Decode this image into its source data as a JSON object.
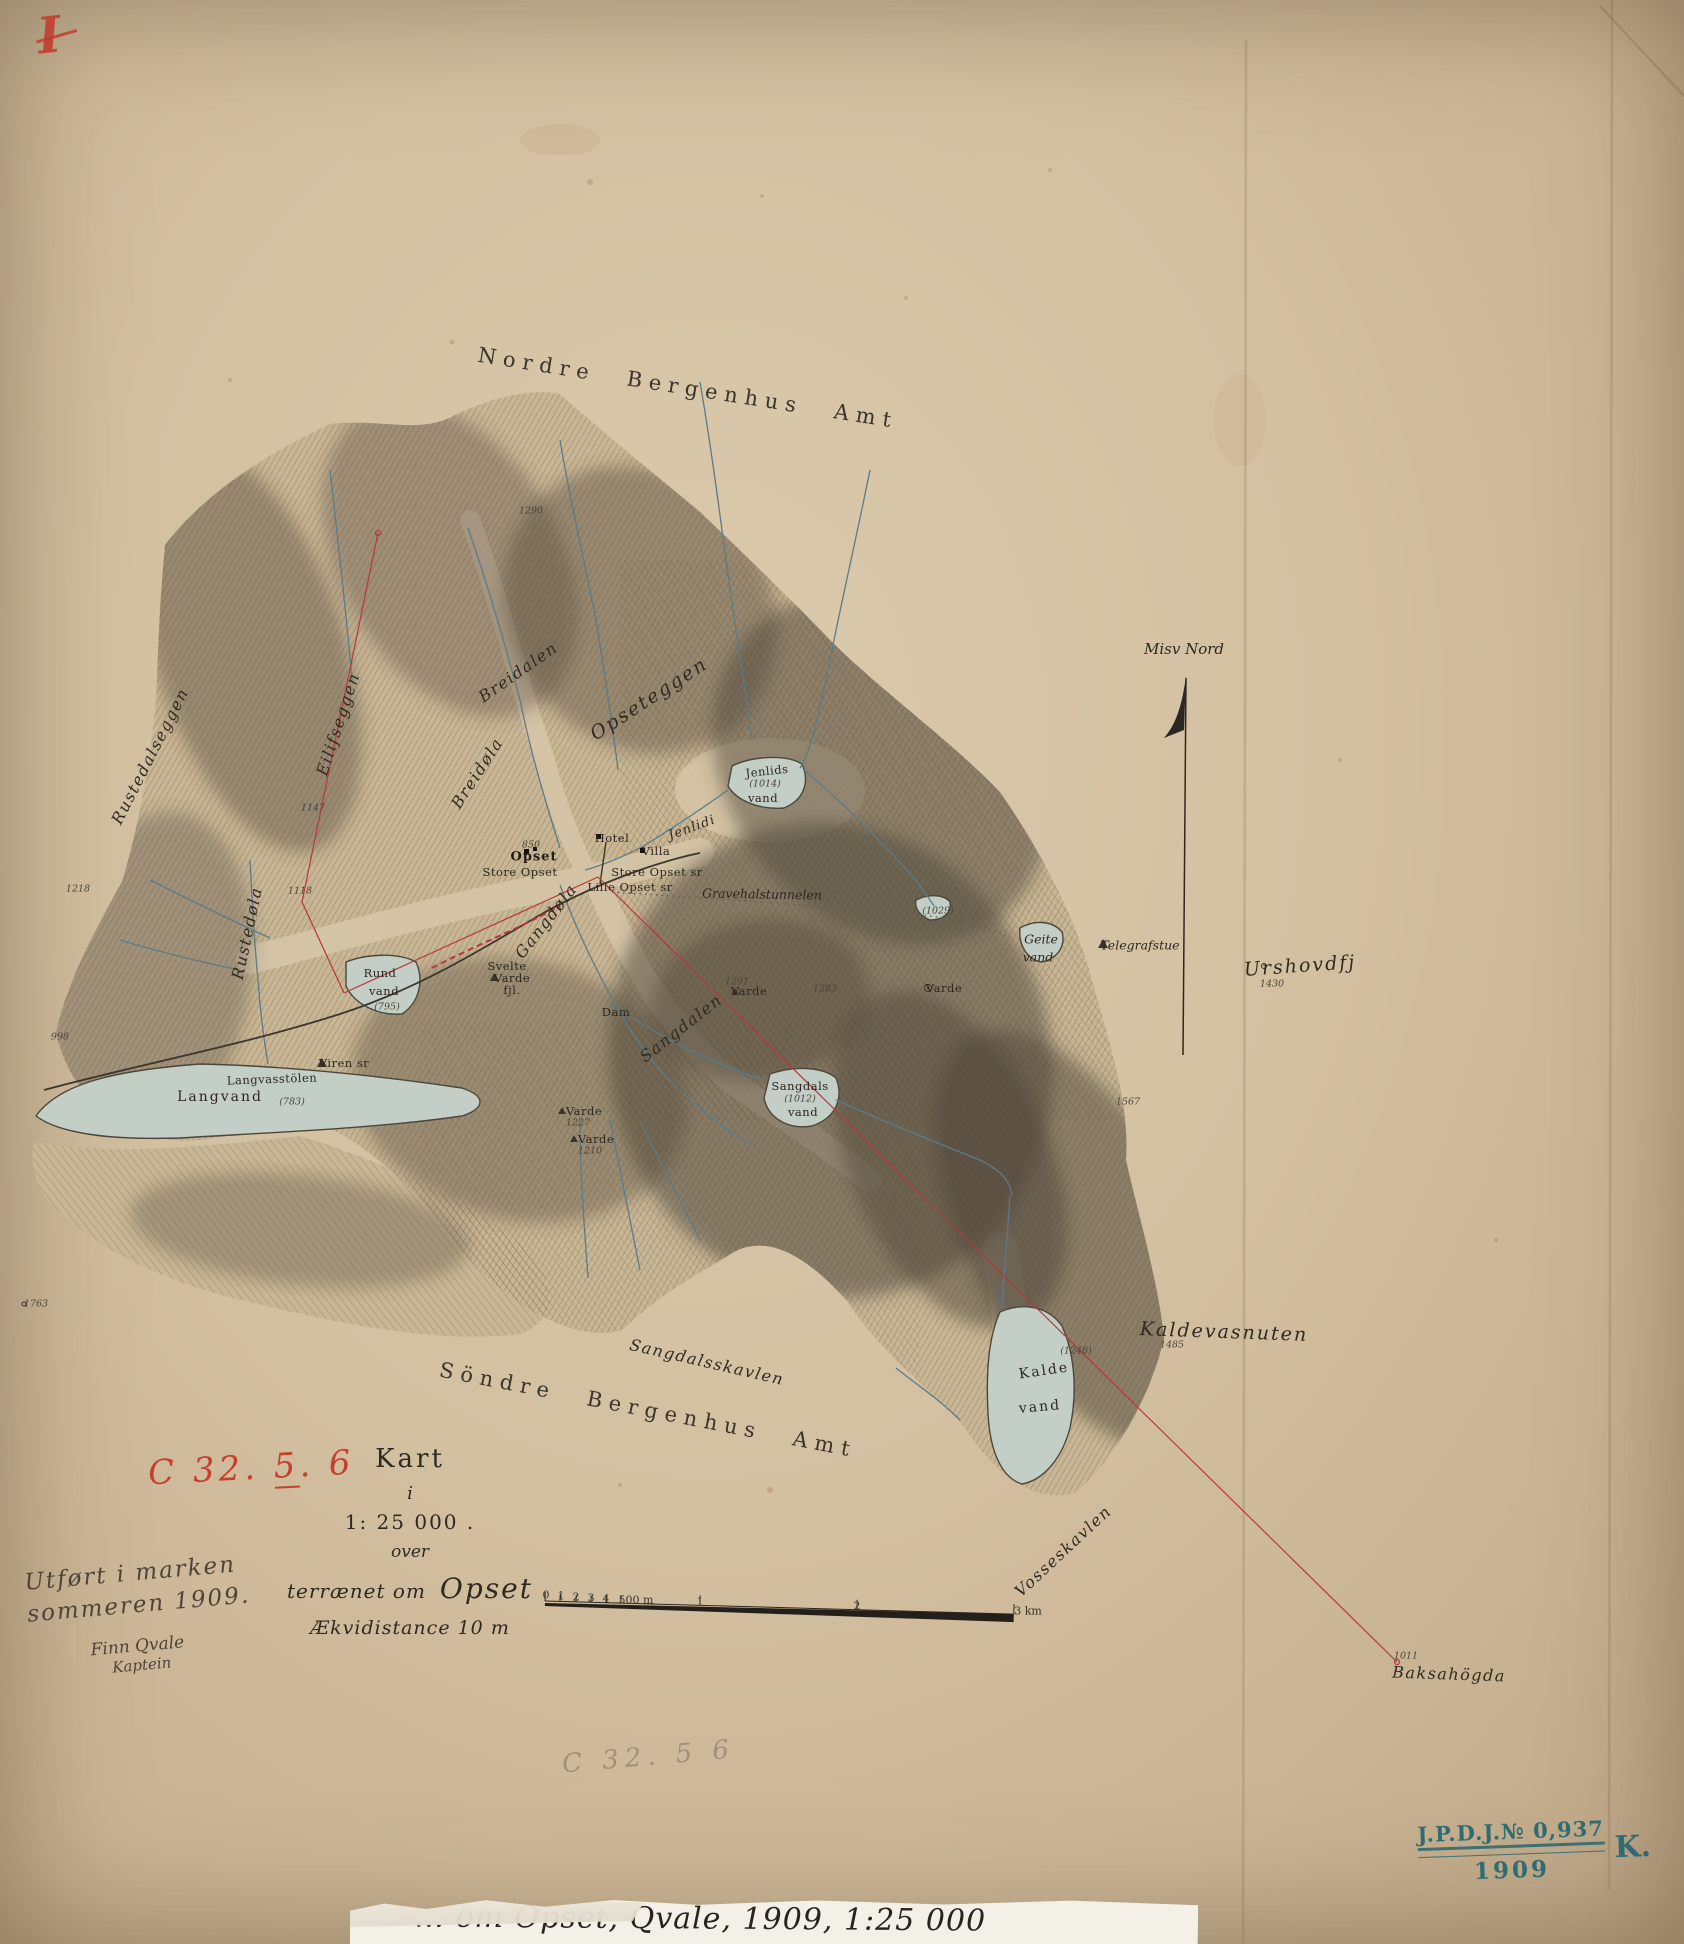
{
  "sheet": {
    "region_top": "Nordre Bergenhus Amt",
    "region_bottom": "Söndre Bergenhus Amt",
    "compass_label": "Misv Nord"
  },
  "codes": {
    "sheet_mark": "I",
    "red_prefix": "C 32. ",
    "red_underlined": "5",
    "red_suffix": ". 6",
    "pencil": "C 32. 5 6"
  },
  "title_block": {
    "line1": "Kart",
    "line2": "i",
    "line3": "1: 25 000 .",
    "line4": "over",
    "line5a": "terrænet om",
    "line5b": "Opset",
    "line6": "Ækvidistance 10 m"
  },
  "surveyor_note": {
    "line1": "Utført i marken",
    "line2": "sommeren 1909.",
    "line3": "Finn Qvale",
    "line4": "Kaptein"
  },
  "stamp": {
    "line1": "J.P.D.J.№ 0,937",
    "year": "1909",
    "suffix": "K."
  },
  "footer_label": {
    "visible_text": "… om Opset, Qvale, 1909, 1:25 000"
  },
  "scale_bar": {
    "minor_labels": [
      "0",
      "1",
      "2",
      "3",
      "4",
      "500 m"
    ],
    "major_labels": [
      "1",
      "2",
      "3 km"
    ]
  },
  "colors": {
    "paper": "#d5c2a3",
    "ink": "#332d24",
    "hachure": "#57503f",
    "water": "#c2cec6",
    "stream": "#5b7b88",
    "red_line": "#b5383b",
    "red_mark": "#c23a2c",
    "stamp_teal": "#2f6b72",
    "pencil": "#8f8572"
  },
  "symbols": {
    "north_arrow": "harpoon-up",
    "station": "triangle",
    "cairn": "triangle",
    "spot_height": "circle",
    "building": "square"
  },
  "map": {
    "labels": [
      {
        "t": "Nordre Bergenhus Amt",
        "x": 688,
        "y": 388,
        "r": 9,
        "c": "amt"
      },
      {
        "t": "Söndre Bergenhus Amt",
        "x": 648,
        "y": 1410,
        "r": 11,
        "c": "amt"
      },
      {
        "t": "Misv Nord",
        "x": 1184,
        "y": 649,
        "r": 0,
        "c": "ital-md"
      },
      {
        "t": "Sangdalsskavlen",
        "x": 707,
        "y": 1362,
        "r": 13,
        "c": "script-md"
      },
      {
        "t": "Vosseskavlen",
        "x": 1063,
        "y": 1551,
        "r": -43,
        "c": "script-md"
      },
      {
        "t": "Kaldevasnuten",
        "x": 1224,
        "y": 1332,
        "r": 2,
        "c": "script-lg"
      },
      {
        "t": "1485",
        "x": 1172,
        "y": 1345,
        "r": 0,
        "c": "elev"
      },
      {
        "t": "Baksahögda",
        "x": 1449,
        "y": 1674,
        "r": 2,
        "c": "script-md"
      },
      {
        "t": "1011",
        "x": 1406,
        "y": 1656,
        "r": 0,
        "c": "elev"
      },
      {
        "t": "Urshovdfj",
        "x": 1300,
        "y": 966,
        "r": -4,
        "c": "script-lg"
      },
      {
        "t": "1430",
        "x": 1272,
        "y": 984,
        "r": 0,
        "c": "elev"
      },
      {
        "t": "Telegrafstue",
        "x": 1140,
        "y": 945,
        "r": 0,
        "c": "ital-sm"
      },
      {
        "t": "Rustedalseggen",
        "x": 150,
        "y": 756,
        "r": -63,
        "c": "script-md"
      },
      {
        "t": "Eilifseggen",
        "x": 338,
        "y": 724,
        "r": -72,
        "c": "script-md"
      },
      {
        "t": "Breidalen",
        "x": 518,
        "y": 672,
        "r": -35,
        "c": "script-md"
      },
      {
        "t": "Breidøla",
        "x": 477,
        "y": 773,
        "r": -57,
        "c": "script-md"
      },
      {
        "t": "Opseteggen",
        "x": 649,
        "y": 699,
        "r": -33,
        "c": "script-lg"
      },
      {
        "t": "Jenlidi",
        "x": 692,
        "y": 828,
        "r": -20,
        "c": "script-sm"
      },
      {
        "t": "Rustedøla",
        "x": 247,
        "y": 933,
        "r": -78,
        "c": "script-md"
      },
      {
        "t": "Gangdøla",
        "x": 546,
        "y": 921,
        "r": -52,
        "c": "script-md"
      },
      {
        "t": "Sangdalen",
        "x": 681,
        "y": 1028,
        "r": -38,
        "c": "script-md"
      },
      {
        "t": "850",
        "x": 531,
        "y": 845,
        "r": 0,
        "c": "elev"
      },
      {
        "t": "Opset",
        "x": 534,
        "y": 857,
        "r": 0,
        "c": "serif-bd"
      },
      {
        "t": "Store Opset",
        "x": 520,
        "y": 872,
        "r": 0,
        "c": "serif-sm"
      },
      {
        "t": "Store Opset sr",
        "x": 657,
        "y": 872,
        "r": 0,
        "c": "serif-sm"
      },
      {
        "t": "Lille Opset sr",
        "x": 630,
        "y": 887,
        "r": 0,
        "c": "serif-sm"
      },
      {
        "t": "Hotel",
        "x": 612,
        "y": 838,
        "r": 0,
        "c": "serif-sm"
      },
      {
        "t": "Villa",
        "x": 656,
        "y": 851,
        "r": 0,
        "c": "serif-sm"
      },
      {
        "t": "Gravehalstunnelen",
        "x": 762,
        "y": 894,
        "r": 1,
        "c": "ital-sm"
      },
      {
        "t": "Dam",
        "x": 616,
        "y": 1012,
        "r": 0,
        "c": "serif-sm"
      },
      {
        "t": "Varde",
        "x": 584,
        "y": 1111,
        "r": 0,
        "c": "serif-sm"
      },
      {
        "t": "1227",
        "x": 578,
        "y": 1123,
        "r": 0,
        "c": "elev"
      },
      {
        "t": "Varde",
        "x": 596,
        "y": 1139,
        "r": 0,
        "c": "serif-sm"
      },
      {
        "t": "1210",
        "x": 590,
        "y": 1151,
        "r": 0,
        "c": "elev"
      },
      {
        "t": "1291",
        "x": 737,
        "y": 982,
        "r": 0,
        "c": "elev"
      },
      {
        "t": "Varde",
        "x": 749,
        "y": 991,
        "r": 0,
        "c": "serif-sm"
      },
      {
        "t": "Varde",
        "x": 944,
        "y": 988,
        "r": 0,
        "c": "serif-sm"
      },
      {
        "t": "1283",
        "x": 825,
        "y": 989,
        "r": 0,
        "c": "elev"
      },
      {
        "t": "Svelte",
        "x": 507,
        "y": 966,
        "r": 0,
        "c": "serif-sm"
      },
      {
        "t": "Varde",
        "x": 512,
        "y": 978,
        "r": 0,
        "c": "serif-sm"
      },
      {
        "t": "fjl.",
        "x": 512,
        "y": 990,
        "r": 0,
        "c": "serif-sm"
      },
      {
        "t": "Viren sr",
        "x": 344,
        "y": 1063,
        "r": 0,
        "c": "serif-sm"
      },
      {
        "t": "Langvasstölen",
        "x": 272,
        "y": 1079,
        "r": -2,
        "c": "serif-sm"
      },
      {
        "t": "Langvand",
        "x": 220,
        "y": 1097,
        "r": 0,
        "c": "serif-md"
      },
      {
        "t": "(783)",
        "x": 292,
        "y": 1102,
        "r": 0,
        "c": "elev"
      },
      {
        "t": "Rund",
        "x": 380,
        "y": 973,
        "r": 0,
        "c": "serif-sm"
      },
      {
        "t": "vand",
        "x": 384,
        "y": 991,
        "r": 0,
        "c": "serif-sm"
      },
      {
        "t": "(795)",
        "x": 387,
        "y": 1007,
        "r": 0,
        "c": "elev"
      },
      {
        "t": "Jenlids",
        "x": 767,
        "y": 771,
        "r": -6,
        "c": "serif-sm"
      },
      {
        "t": "(1014)",
        "x": 765,
        "y": 784,
        "r": 0,
        "c": "elev"
      },
      {
        "t": "vand",
        "x": 763,
        "y": 798,
        "r": 0,
        "c": "serif-sm"
      },
      {
        "t": "Geite",
        "x": 1041,
        "y": 939,
        "r": 0,
        "c": "ital-sm"
      },
      {
        "t": "vand",
        "x": 1038,
        "y": 957,
        "r": 0,
        "c": "ital-sm"
      },
      {
        "t": "(1029)",
        "x": 938,
        "y": 911,
        "r": 0,
        "c": "elev"
      },
      {
        "t": "Sangdals",
        "x": 800,
        "y": 1086,
        "r": 0,
        "c": "serif-sm"
      },
      {
        "t": "(1012)",
        "x": 800,
        "y": 1099,
        "r": 0,
        "c": "elev"
      },
      {
        "t": "vand",
        "x": 803,
        "y": 1112,
        "r": 0,
        "c": "serif-sm"
      },
      {
        "t": "Kalde",
        "x": 1044,
        "y": 1371,
        "r": -8,
        "c": "serif-md"
      },
      {
        "t": "vand",
        "x": 1040,
        "y": 1407,
        "r": -5,
        "c": "serif-md"
      },
      {
        "t": "(1248)",
        "x": 1076,
        "y": 1351,
        "r": 0,
        "c": "elev"
      },
      {
        "t": "1567",
        "x": 1128,
        "y": 1102,
        "r": 0,
        "c": "elev"
      },
      {
        "t": "1763",
        "x": 36,
        "y": 1304,
        "r": 0,
        "c": "elev"
      },
      {
        "t": "998",
        "x": 60,
        "y": 1037,
        "r": 0,
        "c": "elev"
      },
      {
        "t": "1218",
        "x": 78,
        "y": 889,
        "r": 0,
        "c": "elev"
      },
      {
        "t": "1147",
        "x": 313,
        "y": 808,
        "r": 0,
        "c": "elev"
      },
      {
        "t": "1118",
        "x": 300,
        "y": 891,
        "r": 0,
        "c": "elev"
      },
      {
        "t": "1290",
        "x": 531,
        "y": 511,
        "r": 0,
        "c": "elev"
      },
      {
        "t": "0",
        "x": 546,
        "y": 1595,
        "r": 0,
        "c": "scalenum"
      },
      {
        "t": "1",
        "x": 561,
        "y": 1596,
        "r": 0,
        "c": "scalenum"
      },
      {
        "t": "2",
        "x": 576,
        "y": 1597,
        "r": 0,
        "c": "scalenum"
      },
      {
        "t": "3",
        "x": 591,
        "y": 1598,
        "r": 0,
        "c": "scalenum"
      },
      {
        "t": "4",
        "x": 606,
        "y": 1599,
        "r": 0,
        "c": "scalenum"
      },
      {
        "t": "500 m",
        "x": 636,
        "y": 1600,
        "r": 0,
        "c": "scalenum"
      },
      {
        "t": "1",
        "x": 700,
        "y": 1602,
        "r": 0,
        "c": "scalenum"
      },
      {
        "t": "2",
        "x": 857,
        "y": 1606,
        "r": 0,
        "c": "scalenum"
      },
      {
        "t": "3 km",
        "x": 1028,
        "y": 1611,
        "r": 0,
        "c": "scalenum"
      }
    ]
  }
}
